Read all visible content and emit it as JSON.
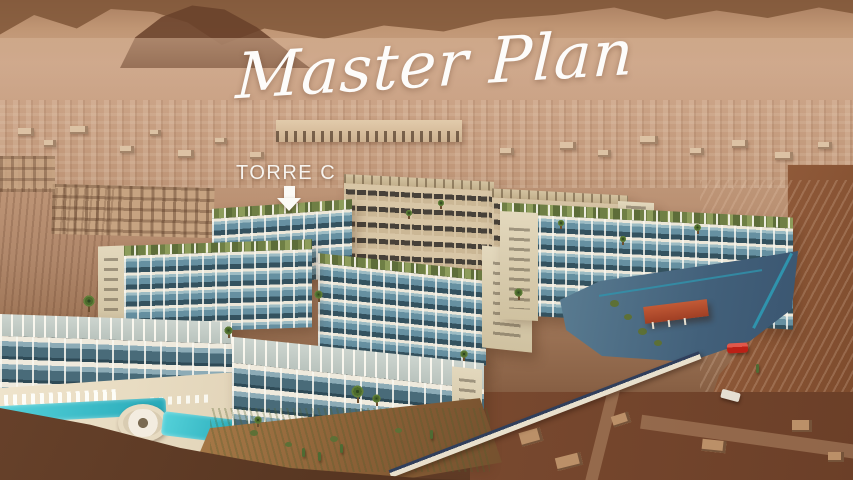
{
  "overlay": {
    "title": "Master Plan",
    "tower_label": "TORRE C",
    "arrow_icon": "down-arrow"
  },
  "palette": {
    "sepia_light": "#cba387",
    "sepia_mid": "#b08a6c",
    "mountain_dark": "#6b4128",
    "foreground_dirt": "#5a3723",
    "right_dirt": "#8a5732",
    "building_white": "#ece7da",
    "building_cream": "#d7c4a4",
    "glass_blue": "#5d8294",
    "roof_garden_green": "#7a8a4e",
    "pool_turquoise": "#3ec1cb",
    "deck_tan": "#e7dbc2",
    "road_blue": "#4f7287",
    "gatehouse_roof_red": "#b44b2d",
    "car_red": "#c4271d",
    "perimeter_wall_navy": "#2a3c57",
    "text_white": "#ffffff"
  }
}
